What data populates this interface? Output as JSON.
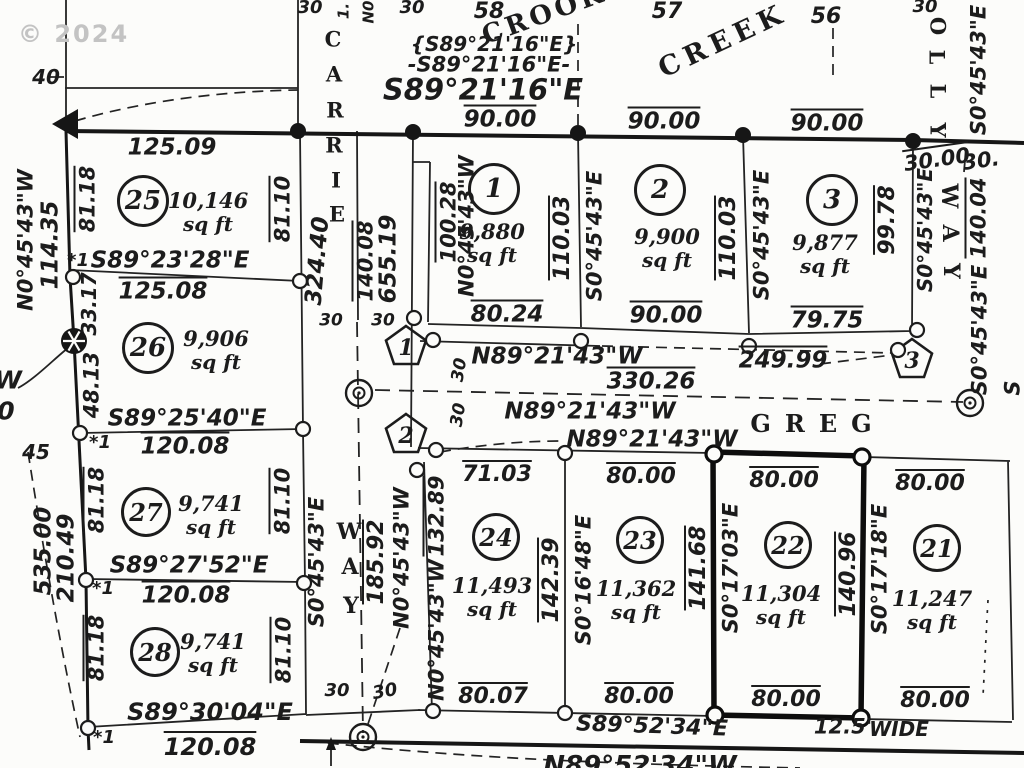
{
  "meta": {
    "watermark": "© 2024",
    "units": "sq ft",
    "highlight_lot": "22",
    "ink": "#1c1c1c"
  },
  "streets": [
    {
      "name": "CARRIE",
      "letters": [
        [
          333,
          39
        ],
        [
          334,
          74
        ],
        [
          335,
          110
        ],
        [
          334,
          145
        ],
        [
          336,
          180
        ],
        [
          337,
          214
        ]
      ],
      "rot": 0,
      "s": 21
    },
    {
      "name": "WAY",
      "letters": [
        [
          349,
          532
        ],
        [
          350,
          567
        ],
        [
          351,
          606
        ]
      ],
      "rot": 0,
      "s": 22
    },
    {
      "name": "OLLY",
      "letters": [
        [
          938,
          26
        ],
        [
          937,
          57
        ],
        [
          938,
          91
        ],
        [
          938,
          130
        ]
      ],
      "rot": 90,
      "s": 21
    },
    {
      "name": "WAY",
      "letters": [
        [
          949,
          196
        ],
        [
          950,
          233
        ],
        [
          951,
          271
        ]
      ],
      "rot": 90,
      "s": 22
    },
    {
      "name": "GREG",
      "x": 818,
      "y": 424,
      "rot": 0,
      "s": 24,
      "ls": 14
    },
    {
      "name": "CROOKED",
      "x": 568,
      "y": 6,
      "rot": -20,
      "s": 26,
      "ls": 4
    },
    {
      "name": "CREEK",
      "x": 723,
      "y": 41,
      "rot": -25,
      "s": 27,
      "ls": 6
    }
  ],
  "lots": [
    {
      "number": "25",
      "area": "10,146",
      "circle": {
        "x": 143,
        "y": 201,
        "d": 52
      },
      "area_xy": {
        "x": 208,
        "y": 212
      }
    },
    {
      "number": "26",
      "area": "9,906",
      "circle": {
        "x": 148,
        "y": 348,
        "d": 52
      },
      "area_xy": {
        "x": 216,
        "y": 350
      }
    },
    {
      "number": "27",
      "area": "9,741",
      "circle": {
        "x": 146,
        "y": 512,
        "d": 50
      },
      "area_xy": {
        "x": 211,
        "y": 515
      }
    },
    {
      "number": "28",
      "area": "9,741",
      "circle": {
        "x": 155,
        "y": 652,
        "d": 50
      },
      "area_xy": {
        "x": 213,
        "y": 653
      }
    },
    {
      "number": "1",
      "area": "9,880",
      "circle": {
        "x": 494,
        "y": 189,
        "d": 52
      },
      "area_xy": {
        "x": 492,
        "y": 243
      }
    },
    {
      "number": "2",
      "area": "9,900",
      "circle": {
        "x": 660,
        "y": 190,
        "d": 52
      },
      "area_xy": {
        "x": 667,
        "y": 248
      }
    },
    {
      "number": "3",
      "area": "9,877",
      "circle": {
        "x": 832,
        "y": 200,
        "d": 52
      },
      "area_xy": {
        "x": 825,
        "y": 254
      }
    },
    {
      "number": "24",
      "area": "11,493",
      "circle": {
        "x": 496,
        "y": 537,
        "d": 48
      },
      "area_xy": {
        "x": 492,
        "y": 597
      }
    },
    {
      "number": "23",
      "area": "11,362",
      "circle": {
        "x": 640,
        "y": 540,
        "d": 48
      },
      "area_xy": {
        "x": 636,
        "y": 600
      }
    },
    {
      "number": "22",
      "area": "11,304",
      "circle": {
        "x": 788,
        "y": 545,
        "d": 48
      },
      "area_xy": {
        "x": 781,
        "y": 605
      }
    },
    {
      "number": "21",
      "area": "11,247",
      "circle": {
        "x": 937,
        "y": 548,
        "d": 48
      },
      "area_xy": {
        "x": 932,
        "y": 610
      }
    }
  ],
  "pentagons": [
    {
      "n": "1",
      "x": 406,
      "y": 347
    },
    {
      "n": "2",
      "x": 406,
      "y": 435
    },
    {
      "n": "3",
      "x": 912,
      "y": 360
    }
  ],
  "markers": {
    "dots": [
      [
        298,
        131
      ],
      [
        413,
        132
      ],
      [
        578,
        133
      ],
      [
        743,
        135
      ],
      [
        913,
        141
      ]
    ],
    "open": [
      [
        73,
        277
      ],
      [
        300,
        281
      ],
      [
        80,
        433
      ],
      [
        303,
        429
      ],
      [
        86,
        580
      ],
      [
        304,
        583
      ],
      [
        88,
        728
      ],
      [
        414,
        318
      ],
      [
        433,
        340
      ],
      [
        581,
        341
      ],
      [
        749,
        346
      ],
      [
        917,
        330
      ],
      [
        898,
        350
      ],
      [
        436,
        450
      ],
      [
        417,
        470
      ],
      [
        565,
        453
      ],
      [
        433,
        711
      ],
      [
        565,
        713
      ]
    ],
    "bold_open": [
      [
        714,
        454
      ],
      [
        862,
        457
      ],
      [
        715,
        715
      ],
      [
        861,
        718
      ]
    ],
    "double": [
      [
        359,
        393
      ],
      [
        970,
        403
      ],
      [
        363,
        737
      ]
    ],
    "hatched": [
      [
        74,
        341
      ]
    ]
  },
  "labels": [
    {
      "t": "40",
      "x": 46,
      "y": 77,
      "s": 20
    },
    {
      "t": "58",
      "x": 489,
      "y": 12,
      "s": 22
    },
    {
      "t": "57",
      "x": 667,
      "y": 12,
      "s": 22
    },
    {
      "t": "56",
      "x": 826,
      "y": 17,
      "s": 22
    },
    {
      "t": "30",
      "x": 310,
      "y": 8,
      "s": 18
    },
    {
      "t": "30",
      "x": 412,
      "y": 8,
      "s": 18
    },
    {
      "t": "1.",
      "x": 344,
      "y": 11,
      "r": -90,
      "s": 15
    },
    {
      "t": "N0",
      "x": 369,
      "y": 12,
      "r": -90,
      "s": 15
    },
    {
      "t": "{S89°21'16\"E}",
      "x": 494,
      "y": 44,
      "s": 20
    },
    {
      "t": "-S89°21'16\"E-",
      "x": 489,
      "y": 65,
      "s": 21
    },
    {
      "t": "S89°21'16\"E",
      "x": 483,
      "y": 90,
      "s": 29,
      "b": 1
    },
    {
      "t": "90.00",
      "x": 500,
      "y": 120,
      "s": 23,
      "ov": 1
    },
    {
      "t": "90.00",
      "x": 664,
      "y": 122,
      "s": 23,
      "ov": 1
    },
    {
      "t": "90.00",
      "x": 827,
      "y": 124,
      "s": 23,
      "ov": 1
    },
    {
      "t": "30",
      "x": 925,
      "y": 7,
      "s": 18
    },
    {
      "t": "N0°45'43\"W",
      "x": 26,
      "y": 240,
      "r": -90,
      "s": 21
    },
    {
      "t": "114.35",
      "x": 51,
      "y": 245,
      "r": -90,
      "s": 23
    },
    {
      "t": "81.18",
      "x": 88,
      "y": 199,
      "r": -90,
      "s": 21,
      "ov": 1
    },
    {
      "t": "125.09",
      "x": 172,
      "y": 148,
      "s": 23
    },
    {
      "t": "*1",
      "x": 78,
      "y": 261,
      "s": 18
    },
    {
      "t": "S89°23'28\"E",
      "x": 170,
      "y": 261,
      "s": 23
    },
    {
      "t": "125.08",
      "x": 163,
      "y": 292,
      "s": 23,
      "ov": 1
    },
    {
      "t": "33.17",
      "x": 89,
      "y": 304,
      "r": -90,
      "s": 20
    },
    {
      "t": "81.10",
      "x": 283,
      "y": 209,
      "r": -90,
      "s": 21,
      "ov": 1
    },
    {
      "t": "324.40",
      "x": 318,
      "y": 261,
      "r": -85,
      "s": 23
    },
    {
      "t": "140.08",
      "x": 366,
      "y": 261,
      "r": -90,
      "s": 21,
      "ov": 1
    },
    {
      "t": "655.19",
      "x": 389,
      "y": 259,
      "r": -90,
      "s": 23
    },
    {
      "t": "30",
      "x": 331,
      "y": 321,
      "s": 17
    },
    {
      "t": "30",
      "x": 383,
      "y": 321,
      "s": 17
    },
    {
      "t": "48.13",
      "x": 92,
      "y": 385,
      "r": -90,
      "s": 21
    },
    {
      "t": "W",
      "x": 8,
      "y": 380,
      "s": 25
    },
    {
      "t": "0",
      "x": 6,
      "y": 411,
      "s": 25
    },
    {
      "t": "S89°25'40\"E",
      "x": 187,
      "y": 419,
      "s": 23
    },
    {
      "t": "45",
      "x": 36,
      "y": 452,
      "s": 20
    },
    {
      "t": "*1",
      "x": 100,
      "y": 443,
      "s": 18
    },
    {
      "t": "120.08",
      "x": 185,
      "y": 447,
      "s": 23,
      "ov": 1
    },
    {
      "t": "81.18",
      "x": 97,
      "y": 500,
      "r": -90,
      "s": 21,
      "ov": 1
    },
    {
      "t": "81.10",
      "x": 283,
      "y": 501,
      "r": -90,
      "s": 21,
      "ov": 1
    },
    {
      "t": "535.00",
      "x": 44,
      "y": 551,
      "r": -90,
      "s": 23
    },
    {
      "t": "210.49",
      "x": 67,
      "y": 558,
      "r": -90,
      "s": 23
    },
    {
      "t": "S0°45'43\"E",
      "x": 317,
      "y": 562,
      "r": -90,
      "s": 21
    },
    {
      "t": "S89°27'52\"E",
      "x": 189,
      "y": 566,
      "s": 23
    },
    {
      "t": "*1",
      "x": 103,
      "y": 589,
      "s": 18
    },
    {
      "t": "120.08",
      "x": 186,
      "y": 596,
      "s": 23,
      "ov": 1
    },
    {
      "t": "81.18",
      "x": 97,
      "y": 648,
      "r": -90,
      "s": 21,
      "ov": 1
    },
    {
      "t": "81.10",
      "x": 284,
      "y": 650,
      "r": -90,
      "s": 21,
      "ov": 1
    },
    {
      "t": "S89°30'04\"E",
      "x": 210,
      "y": 712,
      "s": 24
    },
    {
      "t": "*1",
      "x": 104,
      "y": 738,
      "s": 18
    },
    {
      "t": "120.08",
      "x": 210,
      "y": 747,
      "s": 24,
      "ov": 1
    },
    {
      "t": "185.92",
      "x": 377,
      "y": 562,
      "r": -90,
      "s": 22,
      "ov": 1
    },
    {
      "t": "N0°45'43\"W",
      "x": 402,
      "y": 558,
      "r": -90,
      "s": 21
    },
    {
      "t": "30",
      "x": 337,
      "y": 691,
      "s": 18
    },
    {
      "t": "30",
      "x": 385,
      "y": 692,
      "r": -10,
      "s": 18
    },
    {
      "t": "100.28",
      "x": 449,
      "y": 222,
      "r": -90,
      "s": 21,
      "ov": 1
    },
    {
      "t": "N0°45'43\"W",
      "x": 467,
      "y": 226,
      "r": -90,
      "s": 21
    },
    {
      "t": "110.03",
      "x": 563,
      "y": 238,
      "r": -90,
      "s": 22,
      "ov": 1
    },
    {
      "t": "S0°45'43\"E",
      "x": 595,
      "y": 236,
      "r": -90,
      "s": 21
    },
    {
      "t": "80.24",
      "x": 507,
      "y": 315,
      "s": 23,
      "ov": 1
    },
    {
      "t": "N89°21'43\"W",
      "x": 557,
      "y": 357,
      "s": 23
    },
    {
      "t": "90.00",
      "x": 666,
      "y": 316,
      "s": 23,
      "ov": 1
    },
    {
      "t": "110.03",
      "x": 729,
      "y": 238,
      "r": -90,
      "s": 22,
      "ov": 1
    },
    {
      "t": "S0°45'43\"E",
      "x": 762,
      "y": 235,
      "r": -90,
      "s": 21
    },
    {
      "t": "99.78",
      "x": 888,
      "y": 220,
      "r": -90,
      "s": 22,
      "ov": 1
    },
    {
      "t": "79.75",
      "x": 827,
      "y": 321,
      "s": 23,
      "ov": 1
    },
    {
      "t": "249.99",
      "x": 783,
      "y": 361,
      "s": 23,
      "ov": 1
    },
    {
      "t": "330.26",
      "x": 651,
      "y": 382,
      "s": 23,
      "ov": 1
    },
    {
      "t": "N89°21'43\"W",
      "x": 590,
      "y": 412,
      "s": 23
    },
    {
      "t": "N89°21'43\"W",
      "x": 652,
      "y": 440,
      "s": 23
    },
    {
      "t": "30",
      "x": 460,
      "y": 370,
      "r": -80,
      "s": 17
    },
    {
      "t": "30",
      "x": 459,
      "y": 415,
      "r": -80,
      "s": 17
    },
    {
      "t": "30.00",
      "x": 937,
      "y": 160,
      "r": -8,
      "s": 21,
      "ov": 1
    },
    {
      "t": "30.",
      "x": 981,
      "y": 161,
      "r": -8,
      "s": 21
    },
    {
      "t": "S0°45'43\"E",
      "x": 979,
      "y": 70,
      "r": -90,
      "s": 21
    },
    {
      "t": "S0°45'43\"E",
      "x": 925,
      "y": 230,
      "r": -90,
      "s": 20
    },
    {
      "t": "140.04",
      "x": 979,
      "y": 218,
      "r": -90,
      "s": 21,
      "ov": 1
    },
    {
      "t": "S0°45'43\"E",
      "x": 980,
      "y": 330,
      "r": -90,
      "s": 21
    },
    {
      "t": "S",
      "x": 1013,
      "y": 388,
      "r": -90,
      "s": 21
    },
    {
      "t": "71.03",
      "x": 497,
      "y": 475,
      "s": 22,
      "ov": 1
    },
    {
      "t": "80.00",
      "x": 641,
      "y": 477,
      "s": 22,
      "ov": 1
    },
    {
      "t": "80.00",
      "x": 784,
      "y": 481,
      "s": 22,
      "ov": 1
    },
    {
      "t": "80.00",
      "x": 930,
      "y": 484,
      "s": 22,
      "ov": 1
    },
    {
      "t": "132.89",
      "x": 437,
      "y": 516,
      "r": -90,
      "s": 21,
      "ov": 1
    },
    {
      "t": "N0°45'43\"W",
      "x": 437,
      "y": 630,
      "r": -90,
      "s": 21
    },
    {
      "t": "142.39",
      "x": 552,
      "y": 580,
      "r": -90,
      "s": 22,
      "ov": 1
    },
    {
      "t": "S0°16'48\"E",
      "x": 584,
      "y": 580,
      "r": -90,
      "s": 21
    },
    {
      "t": "141.68",
      "x": 699,
      "y": 568,
      "r": -90,
      "s": 22,
      "ov": 1
    },
    {
      "t": "S0°17'03\"E",
      "x": 731,
      "y": 568,
      "r": -90,
      "s": 21
    },
    {
      "t": "140.96",
      "x": 849,
      "y": 574,
      "r": -90,
      "s": 22,
      "ov": 1
    },
    {
      "t": "S0°17'18\"E",
      "x": 880,
      "y": 569,
      "r": -90,
      "s": 21
    },
    {
      "t": "80.07",
      "x": 493,
      "y": 697,
      "s": 22,
      "ov": 1
    },
    {
      "t": "80.00",
      "x": 639,
      "y": 697,
      "s": 22,
      "ov": 1
    },
    {
      "t": "80.00",
      "x": 786,
      "y": 700,
      "s": 22,
      "ov": 1
    },
    {
      "t": "80.00",
      "x": 935,
      "y": 701,
      "s": 22,
      "ov": 1
    },
    {
      "t": "S89°52'34\"E",
      "x": 652,
      "y": 727,
      "r": 2,
      "s": 22
    },
    {
      "t": "12.5'",
      "x": 843,
      "y": 727,
      "s": 21
    },
    {
      "t": "WIDE",
      "x": 899,
      "y": 729,
      "s": 20
    },
    {
      "t": "N89°52'34\"W",
      "x": 640,
      "y": 766,
      "s": 26
    }
  ]
}
